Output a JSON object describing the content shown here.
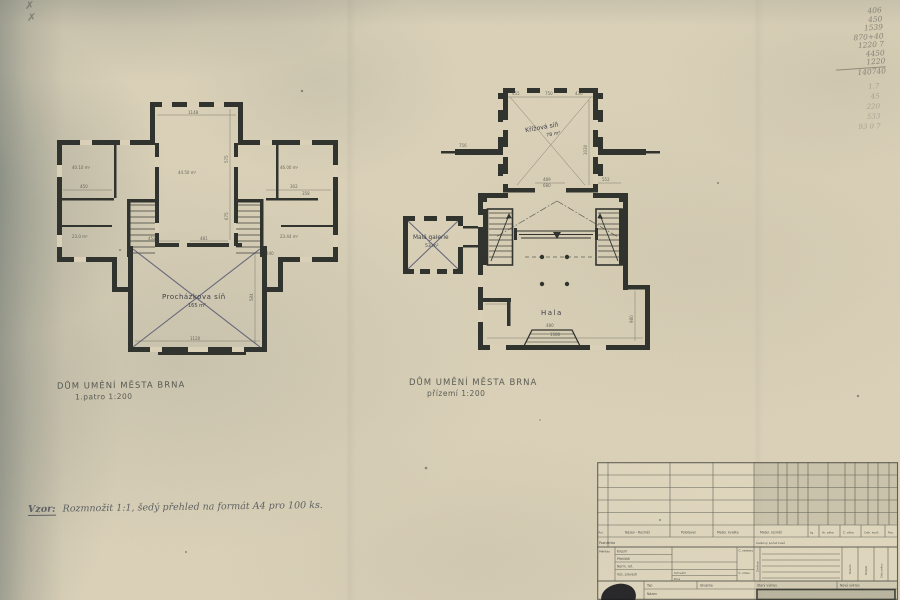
{
  "style": {
    "paper_color": "#dcd2b9",
    "ink_color": "#2e312b",
    "pencil_color": "#7b766a",
    "cross_color": "#4b4e6d"
  },
  "pencil_marks": {
    "m1": "✗",
    "m2": "✗"
  },
  "plan_left": {
    "title": "DŮM UMĚNÍ MĚSTA BRNA",
    "subtitle": "1.patro 1:200",
    "room_label": "Procházkova síň",
    "room_area": "165 m²",
    "dims": [
      "1148",
      "575",
      "675",
      "44.50 m²",
      "40.10 m²",
      "23.0 m²",
      "46.00 m²",
      "23.44 m²",
      "450",
      "302",
      "358",
      "584",
      "1120",
      "481",
      "452",
      "240"
    ]
  },
  "plan_right": {
    "title": "DŮM UMĚNÍ MĚSTA BRNA",
    "subtitle": "přízemí 1:200",
    "top_room_label": "Křížová síň",
    "top_room_area": "78 m²",
    "left_room_label": "Malá galerie",
    "left_room_area": "53 m²",
    "hall_label": "Hala",
    "dims": [
      "750",
      "455",
      "436",
      "1030",
      "489",
      "552",
      "680",
      "567",
      "980",
      "1580",
      "480",
      "756"
    ]
  },
  "handwritten_note": {
    "lead": "Vzor:",
    "text": "Rozmnožit 1:1, šedý přehled na formát A4 pro 100 ks."
  },
  "pencil_calc": {
    "lines": [
      "406",
      "450",
      "1539",
      "870+40",
      "1220 7",
      "4450",
      "1220",
      "140740"
    ],
    "faint_lines": [
      "1.7",
      "45",
      "220",
      "533",
      "93 0 7"
    ]
  },
  "titleblock": {
    "pol": "Pol.",
    "nazev_rozmer": "Název - Rozměr",
    "polotovar": "Polotovar",
    "mater_kvalita": "Mater. kvalita",
    "mater_rozmer": "Mater. rozměr",
    "kg": "kg",
    "hr_vaha": "Hr. váha",
    "c_vaha": "Č. váha",
    "celk_kusu": "Celk. kusů",
    "poz": "Poz.",
    "poznamka": "Poznámka",
    "celkovy_pocet": "Celkový počet kusů",
    "meritko": "Měřítko",
    "kreslil": "Kreslil",
    "prehledl": "Přehlédl",
    "norm_ref": "Norm. ref.",
    "vys_provedl": "Výs. provedl",
    "schvalil": "Schválil",
    "dne": "Dne",
    "c_sestavy": "Č. sestavy",
    "c_zmen": "Č. zmen.",
    "zmena": "Změna",
    "datum": "Datum",
    "podpis": "Podpis",
    "cislo_zmeny": "Číslo změny",
    "typ": "Typ",
    "skupina": "Skupina",
    "nazev": "Název",
    "stary_vykres": "Starý výkres",
    "novy_vykres": "Nový výkres"
  }
}
